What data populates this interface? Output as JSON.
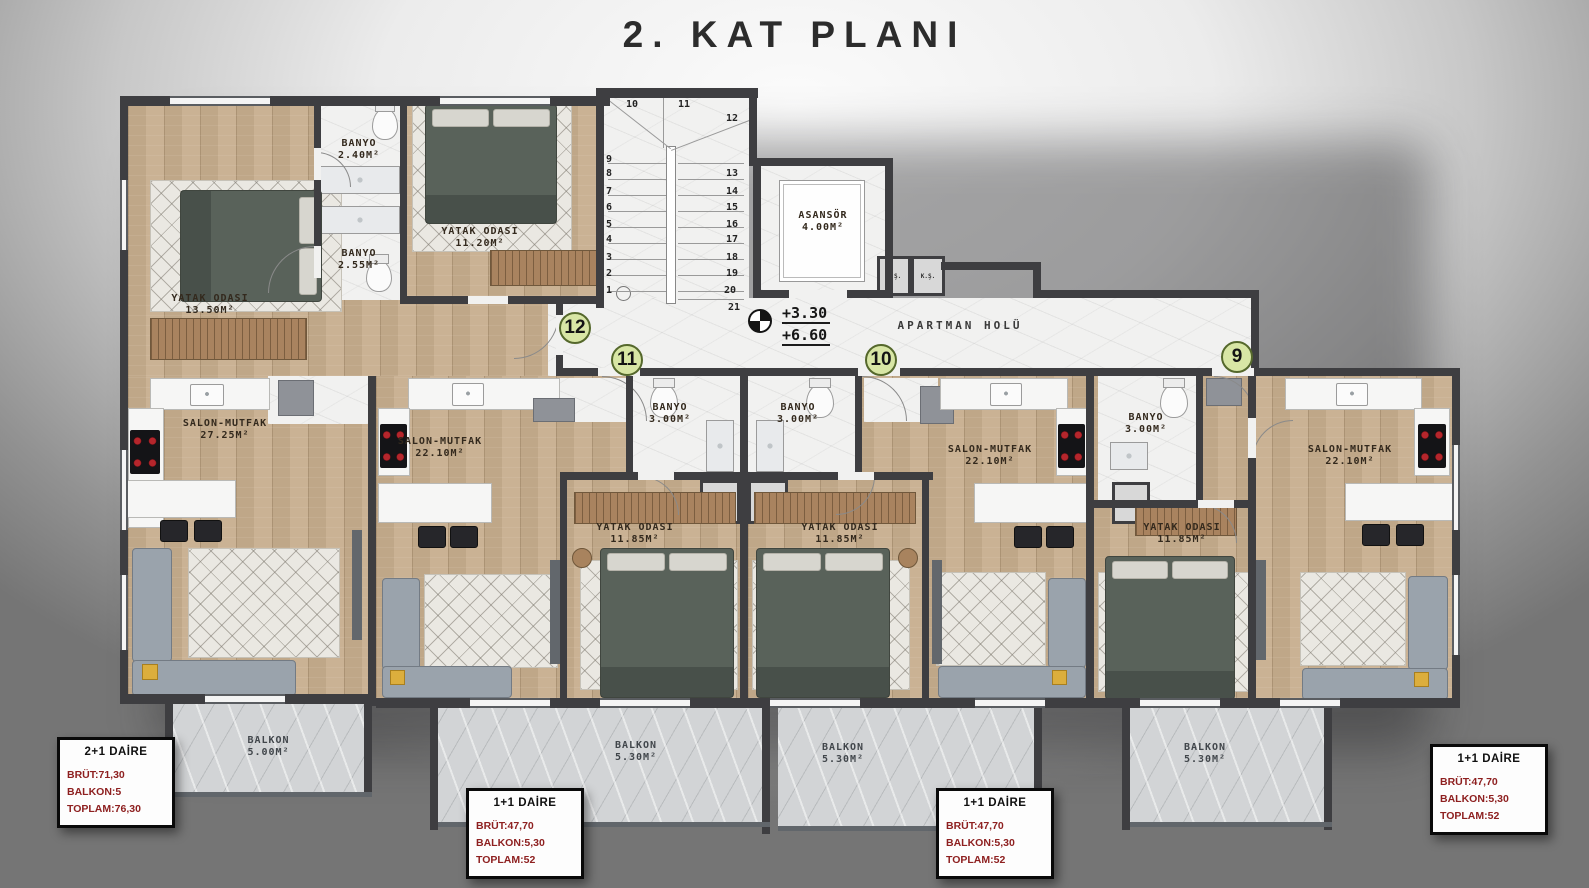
{
  "title": "2. KAT PLANI",
  "badges": [
    "12",
    "11",
    "10",
    "9"
  ],
  "labels": {
    "bedroom_a1": [
      "YATAK ODASI",
      "13.50M²"
    ],
    "banyo_a1": [
      "BANYO",
      "2.40M²"
    ],
    "banyo_a2": [
      "BANYO",
      "2.55M²"
    ],
    "bedroom_a2": [
      "YATAK ODASI",
      "11.20M²"
    ],
    "elevator": [
      "ASANSÖR",
      "4.00M²"
    ],
    "hall": "APARTMAN HOLÜ",
    "level": [
      "+3.30",
      "+6.60"
    ],
    "shaft_left": "H.Ş.",
    "shaft_right": "K.Ş.",
    "salon_a": [
      "SALON-MUTFAK",
      "27.25M²"
    ],
    "salon_b": [
      "SALON-MUTFAK",
      "22.10M²"
    ],
    "salon_c": [
      "SALON-MUTFAK",
      "22.10M²"
    ],
    "salon_d": [
      "SALON-MUTFAK",
      "22.10M²"
    ],
    "banyo_b": [
      "BANYO",
      "3.00M²"
    ],
    "banyo_c": [
      "BANYO",
      "3.00M²"
    ],
    "banyo_d": [
      "BANYO",
      "3.00M²"
    ],
    "ts": "T.Ş",
    "bedroom_b": [
      "YATAK ODASI",
      "11.85M²"
    ],
    "bedroom_c": [
      "YATAK ODASI",
      "11.85M²"
    ],
    "bedroom_d": [
      "YATAK ODASI",
      "11.85M²"
    ],
    "balkon_a": [
      "BALKON",
      "5.00M²"
    ],
    "balkon_b": [
      "BALKON",
      "5.30M²"
    ],
    "balkon_c": [
      "BALKON",
      "5.30M²"
    ],
    "balkon_d": [
      "BALKON",
      "5.30M²"
    ]
  },
  "stairs": [
    "1",
    "2",
    "3",
    "4",
    "5",
    "6",
    "7",
    "8",
    "9",
    "10",
    "11",
    "12",
    "13",
    "14",
    "15",
    "16",
    "17",
    "18",
    "19",
    "20",
    "21"
  ],
  "info_boxes": [
    {
      "title": "2+1 DAİRE",
      "brut": "BRÜT:71,30",
      "balkon": "BALKON:5",
      "toplam": "TOPLAM:76,30"
    },
    {
      "title": "1+1 DAİRE",
      "brut": "BRÜT:47,70",
      "balkon": "BALKON:5,30",
      "toplam": "TOPLAM:52"
    },
    {
      "title": "1+1 DAİRE",
      "brut": "BRÜT:47,70",
      "balkon": "BALKON:5,30",
      "toplam": "TOPLAM:52"
    },
    {
      "title": "1+1 DAİRE",
      "brut": "BRÜT:47,70",
      "balkon": "BALKON:5,30",
      "toplam": "TOPLAM:52"
    }
  ],
  "colors": {
    "wall": "#3e3e41",
    "wood": "#c7ae8e",
    "tile": "#f1f1f0",
    "balcony": "#d2d4d6",
    "badge_green": "#d8e6a5",
    "badge_border": "#55682c",
    "info_red": "#8e2020",
    "title": "#2c2c2c"
  }
}
